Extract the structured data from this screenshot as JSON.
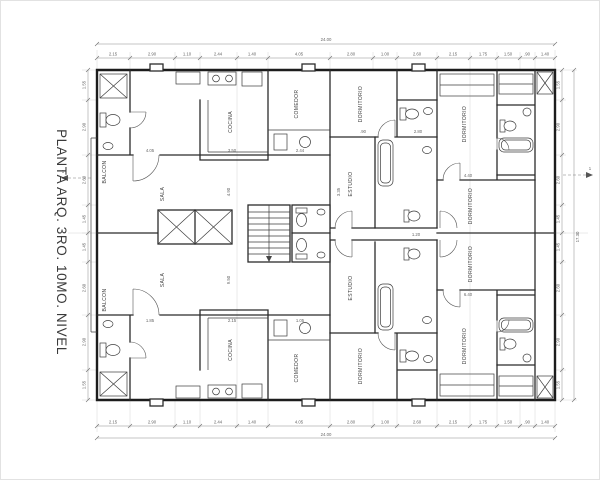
{
  "title": "PLANTA ARQ. 3RO. 10MO. NIVEL",
  "markers": {
    "left": "1",
    "right": "1"
  },
  "labels": {
    "balcon": "BALCON",
    "sala": "SALA",
    "cocina": "COCINA",
    "comedor": "COMEDOR",
    "dormitorio": "DORMITORIO",
    "estudio": "ESTUDIO"
  },
  "totals": {
    "top": "24.00",
    "bottom": "24.00",
    "right": "17.30"
  },
  "dims": {
    "top": [
      "2.15",
      "2.90",
      "1.10",
      "2.44",
      "1.40",
      "4.05",
      "2.80",
      "1.00",
      "2.60",
      "2.15",
      "1.75",
      "1.50",
      ".90",
      "1.40"
    ],
    "side": [
      "1.55",
      "2.90",
      "2.60",
      "1.45",
      "1.45",
      "2.60",
      "2.90",
      "1.55"
    ],
    "interior": [
      "4.05",
      "3.50",
      "2.44",
      "4.90",
      "3.35",
      ".90",
      "2.80",
      "4.40",
      "1.20",
      "9.50",
      "1.85",
      "2.15",
      "1.05",
      "6.40"
    ]
  }
}
